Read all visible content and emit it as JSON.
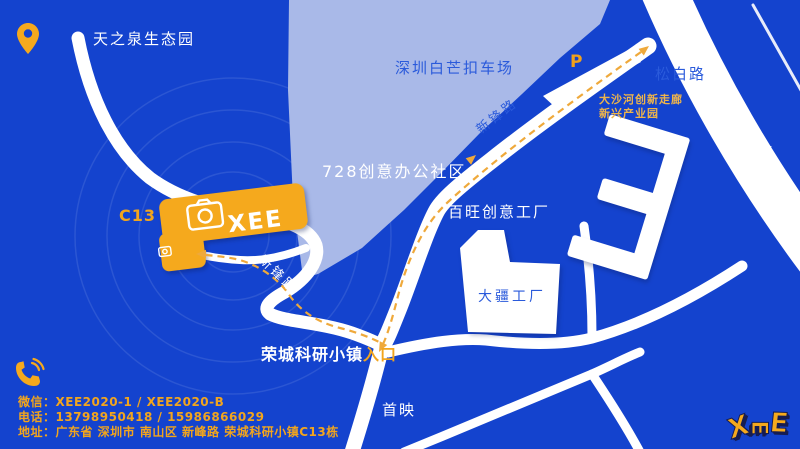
{
  "colors": {
    "background": "#1443CE",
    "road": "#FFFFFF",
    "light_area": "#A9B9E8",
    "map_label_blue": "#2A5ADB",
    "accent_yellow": "#F2A51D",
    "route_yellow": "#EFA93B"
  },
  "map": {
    "poi_top_left": "天之泉生态园",
    "parking_lot_label": "深圳白芒扣车场",
    "parking_symbol": "P",
    "road_songbai": "松白路",
    "corridor_line1": "大沙河创新走廊",
    "corridor_line2": "新兴产业园",
    "footbridge_label": "人行桥",
    "area_728_label": "728创意办公社区",
    "road_xinfeng_upper": "新锋路",
    "road_xinfeng_lower": "新锋路",
    "baiwang_factory_label": "百旺创意工厂",
    "dji_factory_label": "大疆工厂",
    "building_code": "C13",
    "building_logo_text": "XEE",
    "entrance_name": "荣城科研小镇",
    "entrance_highlight": "入口",
    "shouying_label": "首映"
  },
  "contact": {
    "wechat_line": "微信：XEE2020-1 / XEE2020-B",
    "phone_line": "电话：13798950418 / 15986866029",
    "address_line": "地址：广东省 深圳市 南山区 新峰路 荣城科研小镇C13栋"
  },
  "logo": {
    "letter1": "X",
    "letter2": "E",
    "letter3": "E"
  },
  "icons": {
    "location_pin": "location-pin-icon",
    "phone": "phone-icon",
    "camera": "camera-icon"
  }
}
